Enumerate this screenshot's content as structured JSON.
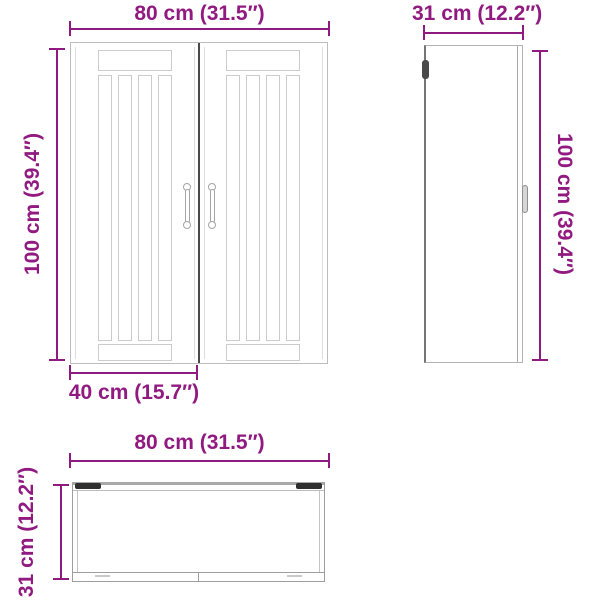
{
  "colors": {
    "dimension": "#911a80",
    "outline_light": "#cccccc",
    "outline_mid": "#9e9e9e",
    "outline_dark": "#4a4a4a",
    "background": "#ffffff"
  },
  "views": {
    "front": {
      "width_label": "80 cm (31.5″)",
      "height_label": "100 cm (39.4″)",
      "door_width_label": "40 cm (15.7″)"
    },
    "side": {
      "width_label": "31 cm (12.2″)",
      "height_label": "100 cm (39.4″)"
    },
    "top": {
      "width_label": "80 cm (31.5″)",
      "depth_label": "31 cm (12.2″)"
    }
  }
}
